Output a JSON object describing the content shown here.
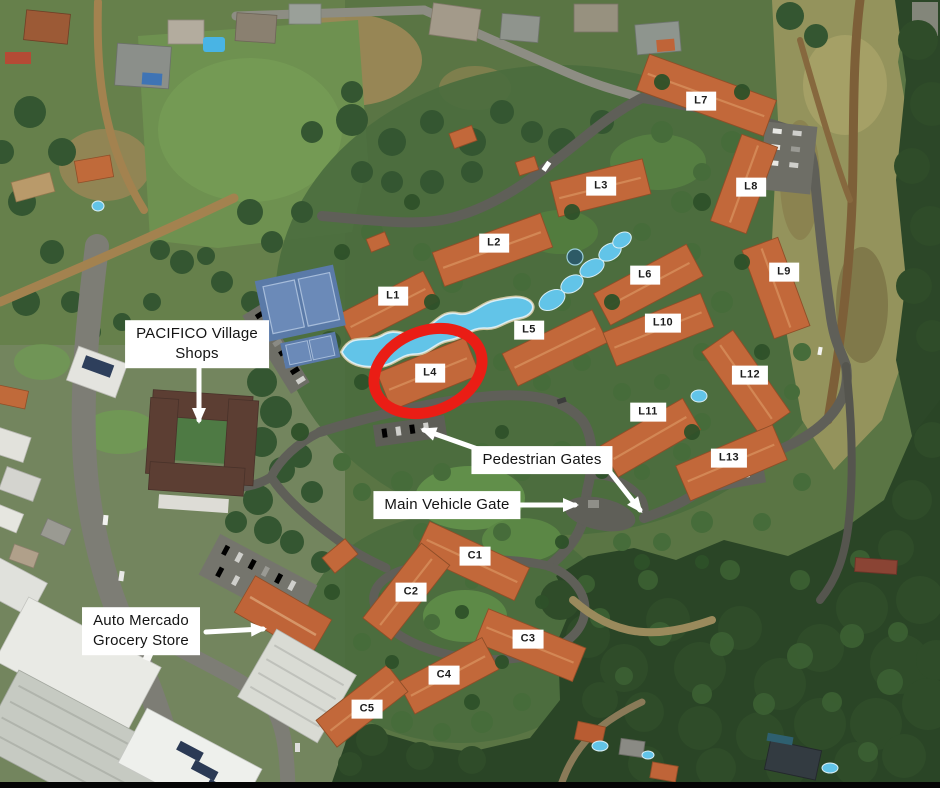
{
  "map": {
    "type": "satellite-aerial-view",
    "annotations": {
      "building_labels": [
        {
          "id": "L1",
          "x": 393,
          "y": 296
        },
        {
          "id": "L2",
          "x": 494,
          "y": 243
        },
        {
          "id": "L3",
          "x": 601,
          "y": 186
        },
        {
          "id": "L4",
          "x": 430,
          "y": 373
        },
        {
          "id": "L5",
          "x": 529,
          "y": 330
        },
        {
          "id": "L6",
          "x": 645,
          "y": 275
        },
        {
          "id": "L7",
          "x": 701,
          "y": 101
        },
        {
          "id": "L8",
          "x": 751,
          "y": 187
        },
        {
          "id": "L9",
          "x": 784,
          "y": 272
        },
        {
          "id": "L10",
          "x": 663,
          "y": 323
        },
        {
          "id": "L11",
          "x": 648,
          "y": 412
        },
        {
          "id": "L12",
          "x": 750,
          "y": 375
        },
        {
          "id": "L13",
          "x": 729,
          "y": 458
        },
        {
          "id": "C1",
          "x": 475,
          "y": 556
        },
        {
          "id": "C2",
          "x": 411,
          "y": 592
        },
        {
          "id": "C3",
          "x": 528,
          "y": 639
        },
        {
          "id": "C4",
          "x": 444,
          "y": 675
        },
        {
          "id": "C5",
          "x": 367,
          "y": 709
        }
      ],
      "callouts": [
        {
          "id": "pacifico-village-shops",
          "lines": [
            "PACIFICO Village",
            "Shops"
          ],
          "cx": 197,
          "cy": 344
        },
        {
          "id": "pedestrian-gates",
          "lines": [
            "Pedestrian Gates"
          ],
          "cx": 542,
          "cy": 460
        },
        {
          "id": "main-vehicle-gate",
          "lines": [
            "Main Vehicle Gate"
          ],
          "cx": 447,
          "cy": 505
        },
        {
          "id": "auto-mercado-grocery-store",
          "lines": [
            "Auto Mercado",
            "Grocery Store"
          ],
          "cx": 141,
          "cy": 631
        }
      ],
      "arrows": [
        {
          "id": "pacifico-arrow",
          "x1": 199,
          "y1": 367,
          "x2": 199,
          "y2": 420
        },
        {
          "id": "pedestrian-gate-left-arrow",
          "x1": 486,
          "y1": 452,
          "x2": 424,
          "y2": 430
        },
        {
          "id": "pedestrian-gate-right-arrow",
          "x1": 610,
          "y1": 472,
          "x2": 640,
          "y2": 510
        },
        {
          "id": "main-vehicle-gate-arrow",
          "x1": 517,
          "y1": 505,
          "x2": 575,
          "y2": 505
        },
        {
          "id": "auto-mercado-arrow",
          "x1": 206,
          "y1": 632,
          "x2": 263,
          "y2": 629
        }
      ],
      "highlight": {
        "id": "l4-highlight",
        "shape": "ellipse",
        "cx": 428,
        "cy": 371,
        "rx": 56,
        "ry": 40,
        "rotation": -22,
        "color": "#ea1d15",
        "stroke_width": 11
      },
      "arrow_color": "#ffffff",
      "label_bg": "#ffffff",
      "label_text_color": "#1c1c1c"
    }
  }
}
